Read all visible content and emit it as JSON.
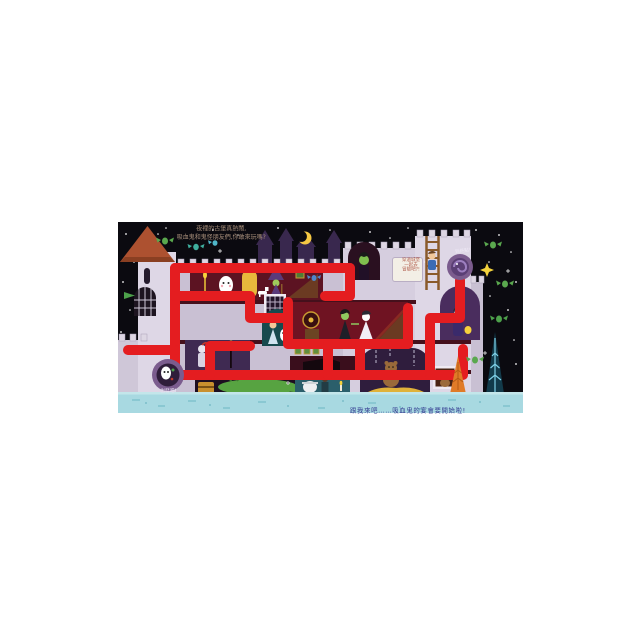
{
  "page": {
    "background": "#ffffff",
    "kind": "maze-book-spread"
  },
  "illustration": {
    "top_caption": {
      "line1": "夜裡的古堡真熱鬧,",
      "line2": "吸血鬼和鬼怪朋友們,你敢來玩嗎?",
      "color": "#a9907c"
    },
    "wall_sign": {
      "line1": "穿過城堡",
      "line2": "一起去",
      "line3": "冒險吧?!"
    },
    "finish_hint": "到終點!",
    "start_label": "出發吧!",
    "bottom_caption": {
      "text": "跟我來吧……吸血鬼的宴會要開始啦!",
      "color": "#31378f"
    },
    "colors": {
      "maze_path": "#e41d20",
      "sky": "#0b0a10",
      "water": "#a8d9e1",
      "castle_wall": "#cfc7d8",
      "tower_roof": "#ad5130",
      "portal_ring": "#7b5c8e",
      "moon": "#f6c844",
      "room_red": "#5c1322",
      "room_purple": "#3f2a52",
      "room_teal": "#174a4e"
    },
    "icons": {
      "moon": "crescent-moon-icon",
      "start": "start-portal-icon",
      "finish": "finish-portal-icon",
      "ghost": "ghost-icon",
      "witch": "witch-icon",
      "vampire_couple": "vampire-dancers-icon",
      "crocodile": "crocodile-icon",
      "knight": "knight-armour-icon",
      "teddy": "teddy-bear-icon",
      "ladder_boy": "boy-on-ladder-icon",
      "bats": "bat-icon",
      "trees": "pine-tree-icon"
    }
  }
}
